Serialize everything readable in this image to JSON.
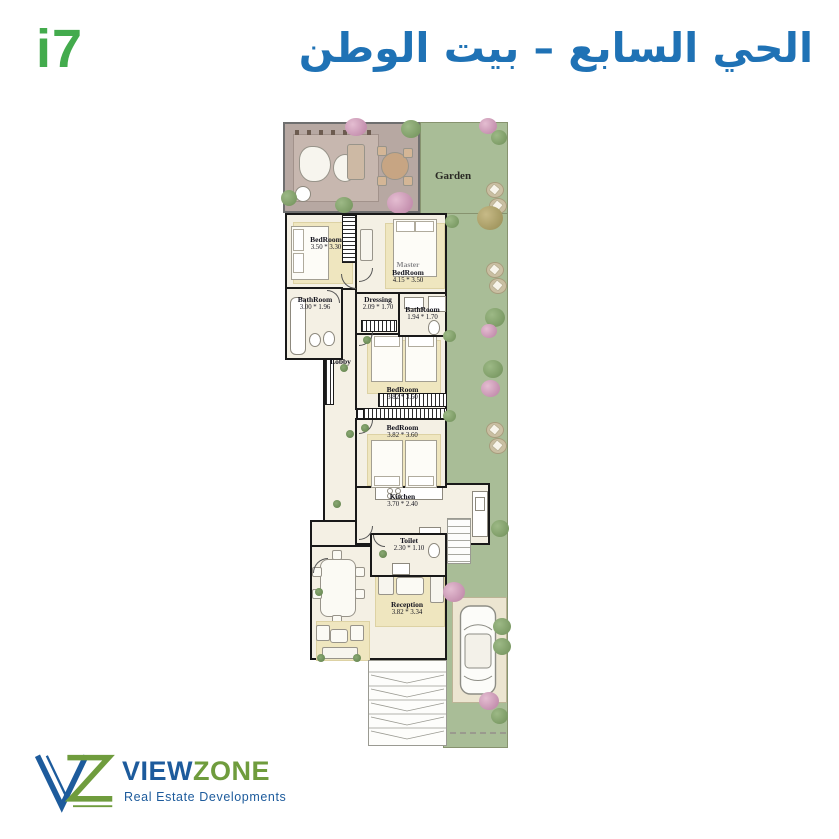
{
  "header": {
    "unit_code": "i7",
    "title_arabic": "الحي السابع – بيت الوطن"
  },
  "plan": {
    "garden_label": "Garden",
    "rooms": [
      {
        "id": "bedroom-1",
        "name": "BedRoom",
        "dims": "3.50 * 3.30"
      },
      {
        "id": "master-bedroom",
        "name_prefix": "Master",
        "name": "BedRoom",
        "dims": "4.15 * 3.50"
      },
      {
        "id": "bathroom-1",
        "name": "BathRoom",
        "dims": "3.00 * 1.96"
      },
      {
        "id": "dressing",
        "name": "Dressing",
        "dims": "2.09 * 1.70"
      },
      {
        "id": "bathroom-2",
        "name": "BathRoom",
        "dims": "1.94 * 1.70"
      },
      {
        "id": "lobby",
        "name": "Lobby",
        "dims": ""
      },
      {
        "id": "bedroom-3",
        "name": "BedRoom",
        "dims": "3.82 * 3.60"
      },
      {
        "id": "bedroom-4",
        "name": "BedRoom",
        "dims": "3.82 * 3.60"
      },
      {
        "id": "kitchen",
        "name": "Kitchen",
        "dims": "3.70 * 2.40"
      },
      {
        "id": "toilet",
        "name": "Toilet",
        "dims": "2.30 * 1.10"
      },
      {
        "id": "reception",
        "name": "Reception",
        "dims": "3.82 * 3.34"
      }
    ]
  },
  "footer": {
    "brand_view": "VIEW",
    "brand_zone": "ZONE",
    "tagline": "Real Estate Developments"
  },
  "colors": {
    "logo_green": "#43ab4d",
    "title_blue": "#1f72b5",
    "garden_green": "#a9bd97",
    "brand_blue": "#1d5b9c",
    "brand_green": "#6f9c3d"
  }
}
